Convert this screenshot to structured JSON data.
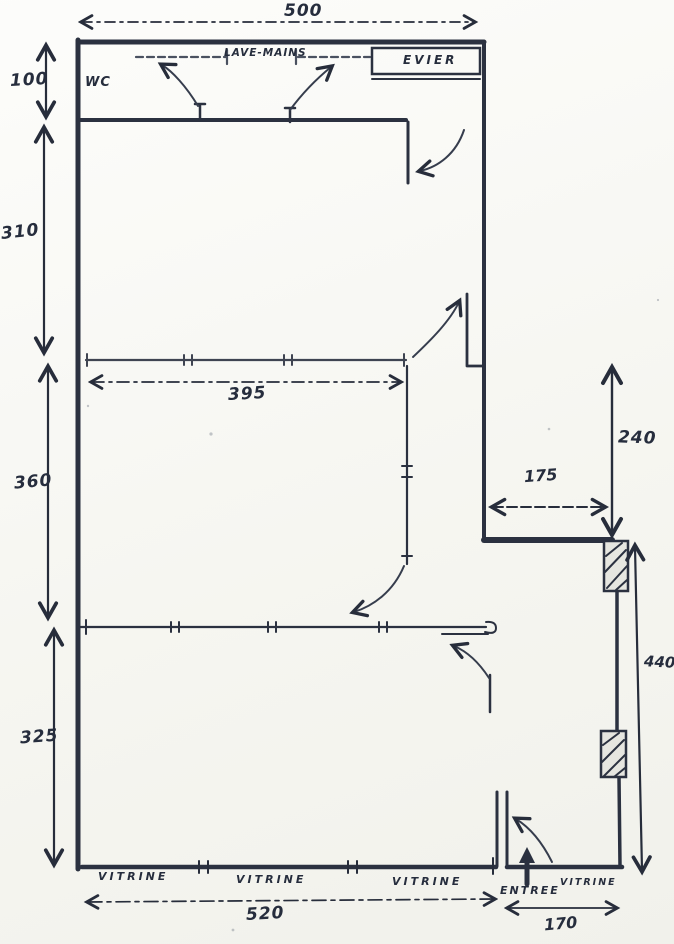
{
  "colors": {
    "ink": "#2b3140",
    "ink_light": "#4a5160",
    "paper": "#f9f9f4"
  },
  "rooms": {
    "wc_label": "WC",
    "counter_label": "LAVE-MAINS",
    "sink_label": "EVIER",
    "entrance_label": "ENTREE"
  },
  "shopfront": {
    "vitrines": [
      "VITRINE",
      "VITRINE",
      "VITRINE",
      "VITRINE"
    ]
  },
  "dimensions": {
    "top_width": "500",
    "left_wc_height": "100",
    "left_upper_room_height": "310",
    "left_middle_room_height": "360",
    "left_lower_room_height": "325",
    "interior_width": "395",
    "right_upper_height": "240",
    "niche_width": "175",
    "right_lower_height": "440",
    "bottom_main_width": "520",
    "bottom_right_width": "170"
  }
}
